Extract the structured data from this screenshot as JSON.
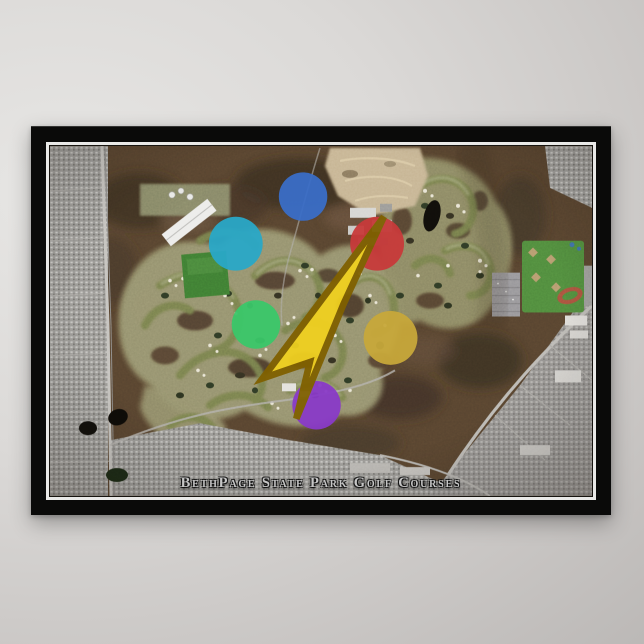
{
  "backdrop": {
    "type": "studio-gradient-wall",
    "color_light": "#e7e6e4",
    "color_dark": "#b2afad"
  },
  "poster": {
    "title": "BethPage State Park Golf Courses",
    "frame_color": "#0a0a09",
    "pinstripe_color": "#e9e9e7",
    "title_color": "#c6c6c6",
    "logo": "publisher-compass-logo"
  },
  "map": {
    "kind": "satellite-aerial-photo",
    "palette": {
      "woods": "#56432f",
      "woods_dark": "#3c2f23",
      "fairway": "#77804e",
      "rough": "#989672",
      "suburb": "#989794",
      "sand_pit": "#c6b493",
      "field_green": "#3e7c33",
      "ballfield_green": "#4f8a3d",
      "pond": "#100e0a",
      "track_red": "#a8523e",
      "road": "#b8b6b2",
      "bunker_sand": "#e8e4d4",
      "building_white": "#ececea"
    },
    "features": [
      "left-suburbs",
      "parkway",
      "woods",
      "golf-fairways",
      "sand-pit",
      "industrial-buildings",
      "pond",
      "ballfields-complex",
      "running-track",
      "parking-lot",
      "clubhouse",
      "bottom-suburbs",
      "urban-street-grid",
      "boulevard",
      "green-field",
      "white-warehouse",
      "water-tanks",
      "publisher-compass-logo"
    ]
  }
}
